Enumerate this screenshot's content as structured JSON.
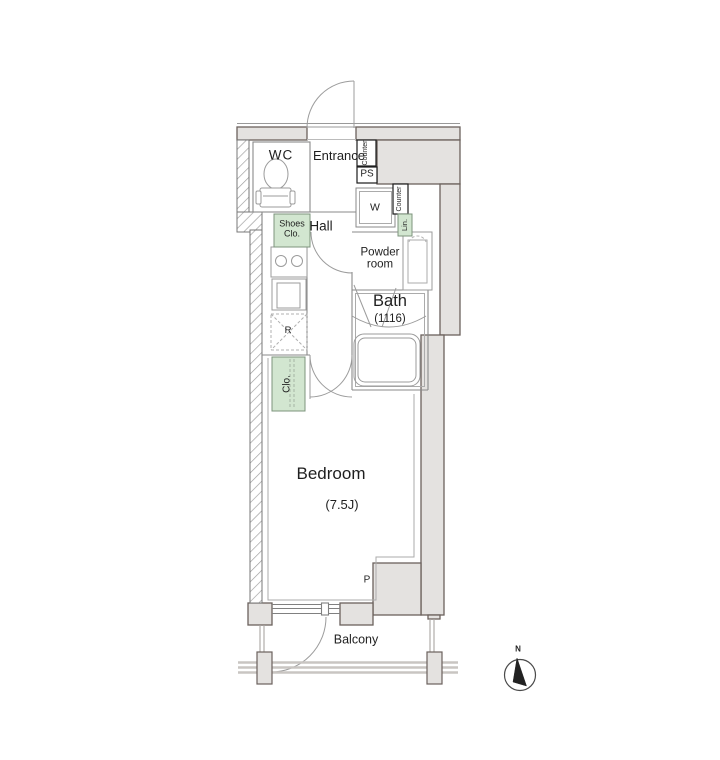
{
  "plan": {
    "labels": {
      "wc": "WC",
      "entrance": "Entrance",
      "counter_top": "Counter",
      "ps": "PS",
      "washer": "W",
      "counter_side": "Counter",
      "linen": "Lin.",
      "shoes_closet": "Shoes Clo.",
      "hall": "Hall",
      "powder_room": "Powder room",
      "bath": "Bath",
      "bath_size": "(1116)",
      "refrigerator": "R",
      "closet": "Clo.",
      "bedroom": "Bedroom",
      "bedroom_size": "(7.5J)",
      "pipe_space": "P",
      "balcony": "Balcony",
      "compass_north": "N"
    },
    "colors": {
      "wall": "#e4e2e0",
      "wall_border": "#6b625d",
      "line": "#8a8a8a",
      "fixture": "#9b9b9b",
      "inner": "#ababab",
      "green": "#d2e6d0",
      "green_border": "#7d947d",
      "black_box": "#1c1c1c",
      "rail": "#c9c5c2",
      "text": "#1f1f1f"
    }
  }
}
